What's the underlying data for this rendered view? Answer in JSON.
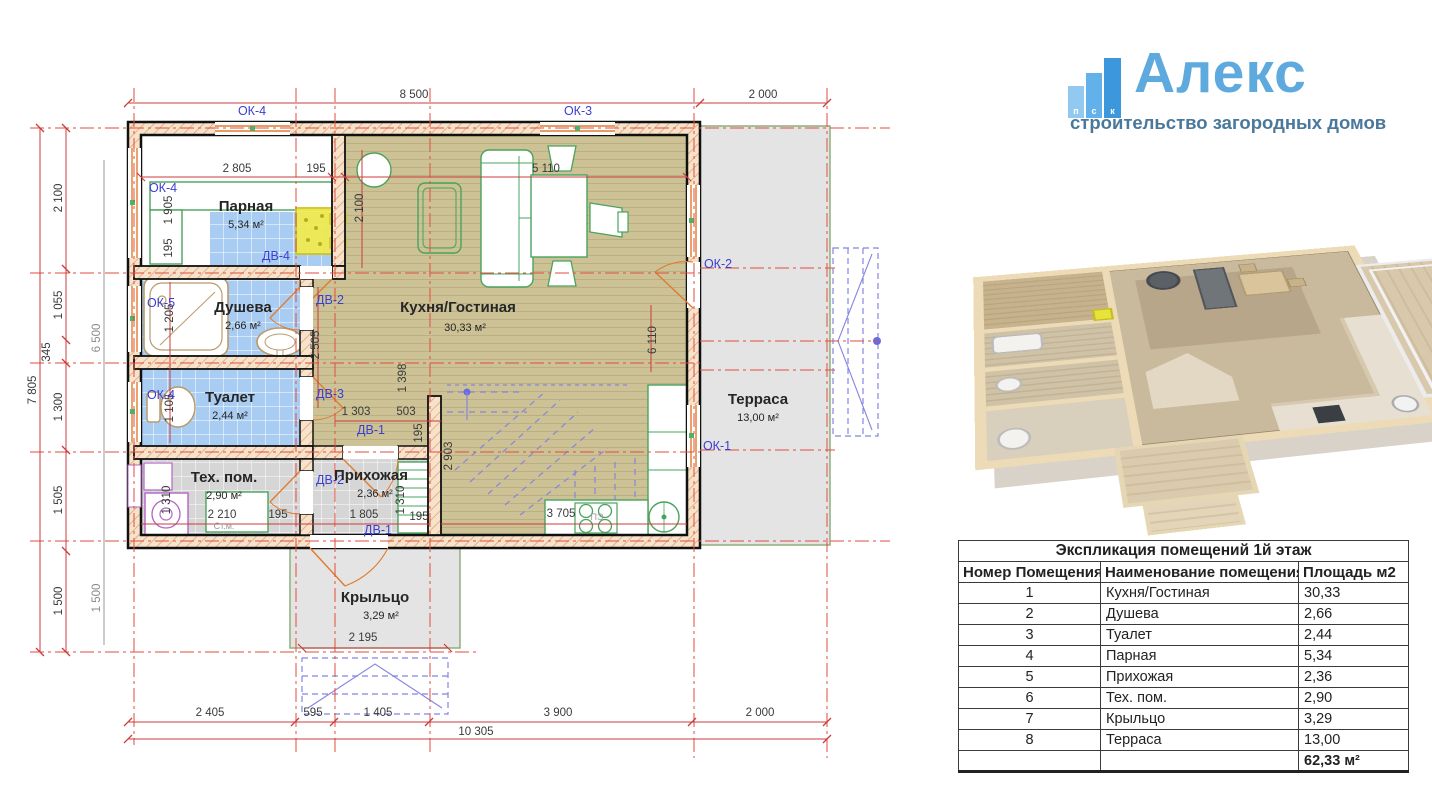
{
  "brand": {
    "icon_letters": [
      "п",
      "с",
      "к"
    ],
    "name": "Алекс",
    "tagline": "строительство загородных домов",
    "accent_color": "#5ea9dd",
    "tagline_color": "#49789b"
  },
  "plan": {
    "rooms": [
      {
        "name": "Парная",
        "area": "5,34 м²"
      },
      {
        "name": "Душева",
        "area": "2,66 м²"
      },
      {
        "name": "Туалет",
        "area": "2,44 м²"
      },
      {
        "name": "Тех. пом.",
        "area": "2,90 м²"
      },
      {
        "name": "Прихожая",
        "area": "2,36 м²"
      },
      {
        "name": "Кухня/Гостиная",
        "area": "30,33 м²"
      },
      {
        "name": "Терраса",
        "area": "13,00 м²"
      },
      {
        "name": "Крыльцо",
        "area": "3,29 м²"
      }
    ],
    "op": {
      "ok1": "ОК-1",
      "ok2": "ОК-2",
      "ok3": "ОК-3",
      "ok4": "ОК-4",
      "ok5": "ОК-5",
      "dv1": "ДВ-1",
      "dv2": "ДВ-2",
      "dv3": "ДВ-3",
      "dv4": "ДВ-4"
    },
    "n": {
      "washer": "Ст.м.",
      "stove": "ПЭ"
    },
    "d": {
      "t8500": "8 500",
      "t2000": "2 000",
      "l7805": "7 805",
      "l2100": "2 100",
      "l1055": "1 055",
      "l345": "345",
      "l1300": "1 300",
      "l1505": "1 505",
      "l1500": "1 500",
      "l6500": "6 500",
      "lp1500": "1 500",
      "b2405": "2 405",
      "b595": "595",
      "b1405": "1 405",
      "b3900": "3 900",
      "b2000": "2 000",
      "b10305": "10 305",
      "i2805": "2 805",
      "i195a": "195",
      "i1905": "1 905",
      "i195b": "195",
      "i2100": "2 100",
      "i5110": "5 110",
      "i1205": "1 205",
      "i1105": "1 105",
      "i2505": "2 505",
      "i1303": "1 303",
      "i503": "503",
      "i195c": "195",
      "i1398": "1 398",
      "i2903": "2 903",
      "i1310a": "1 310",
      "i2210": "2 210",
      "i195d": "195",
      "i1805": "1 805",
      "i1310b": "1 310",
      "i195e": "195",
      "i3705": "3 705",
      "i6110": "6 110",
      "i2195": "2 195"
    }
  },
  "table": {
    "title": "Экспликация помещений 1й этаж",
    "headers": [
      "Номер Помещения",
      "Наименование помещения",
      "Площадь м2"
    ],
    "rows": [
      [
        "1",
        "Кухня/Гостиная",
        "30,33"
      ],
      [
        "2",
        "Душева",
        "2,66"
      ],
      [
        "3",
        "Туалет",
        "2,44"
      ],
      [
        "4",
        "Парная",
        "5,34"
      ],
      [
        "5",
        "Прихожая",
        "2,36"
      ],
      [
        "6",
        "Тех. пом.",
        "2,90"
      ],
      [
        "7",
        "Крыльцо",
        "3,29"
      ],
      [
        "8",
        "Терраса",
        "13,00"
      ]
    ],
    "total": "62,33 м²"
  }
}
